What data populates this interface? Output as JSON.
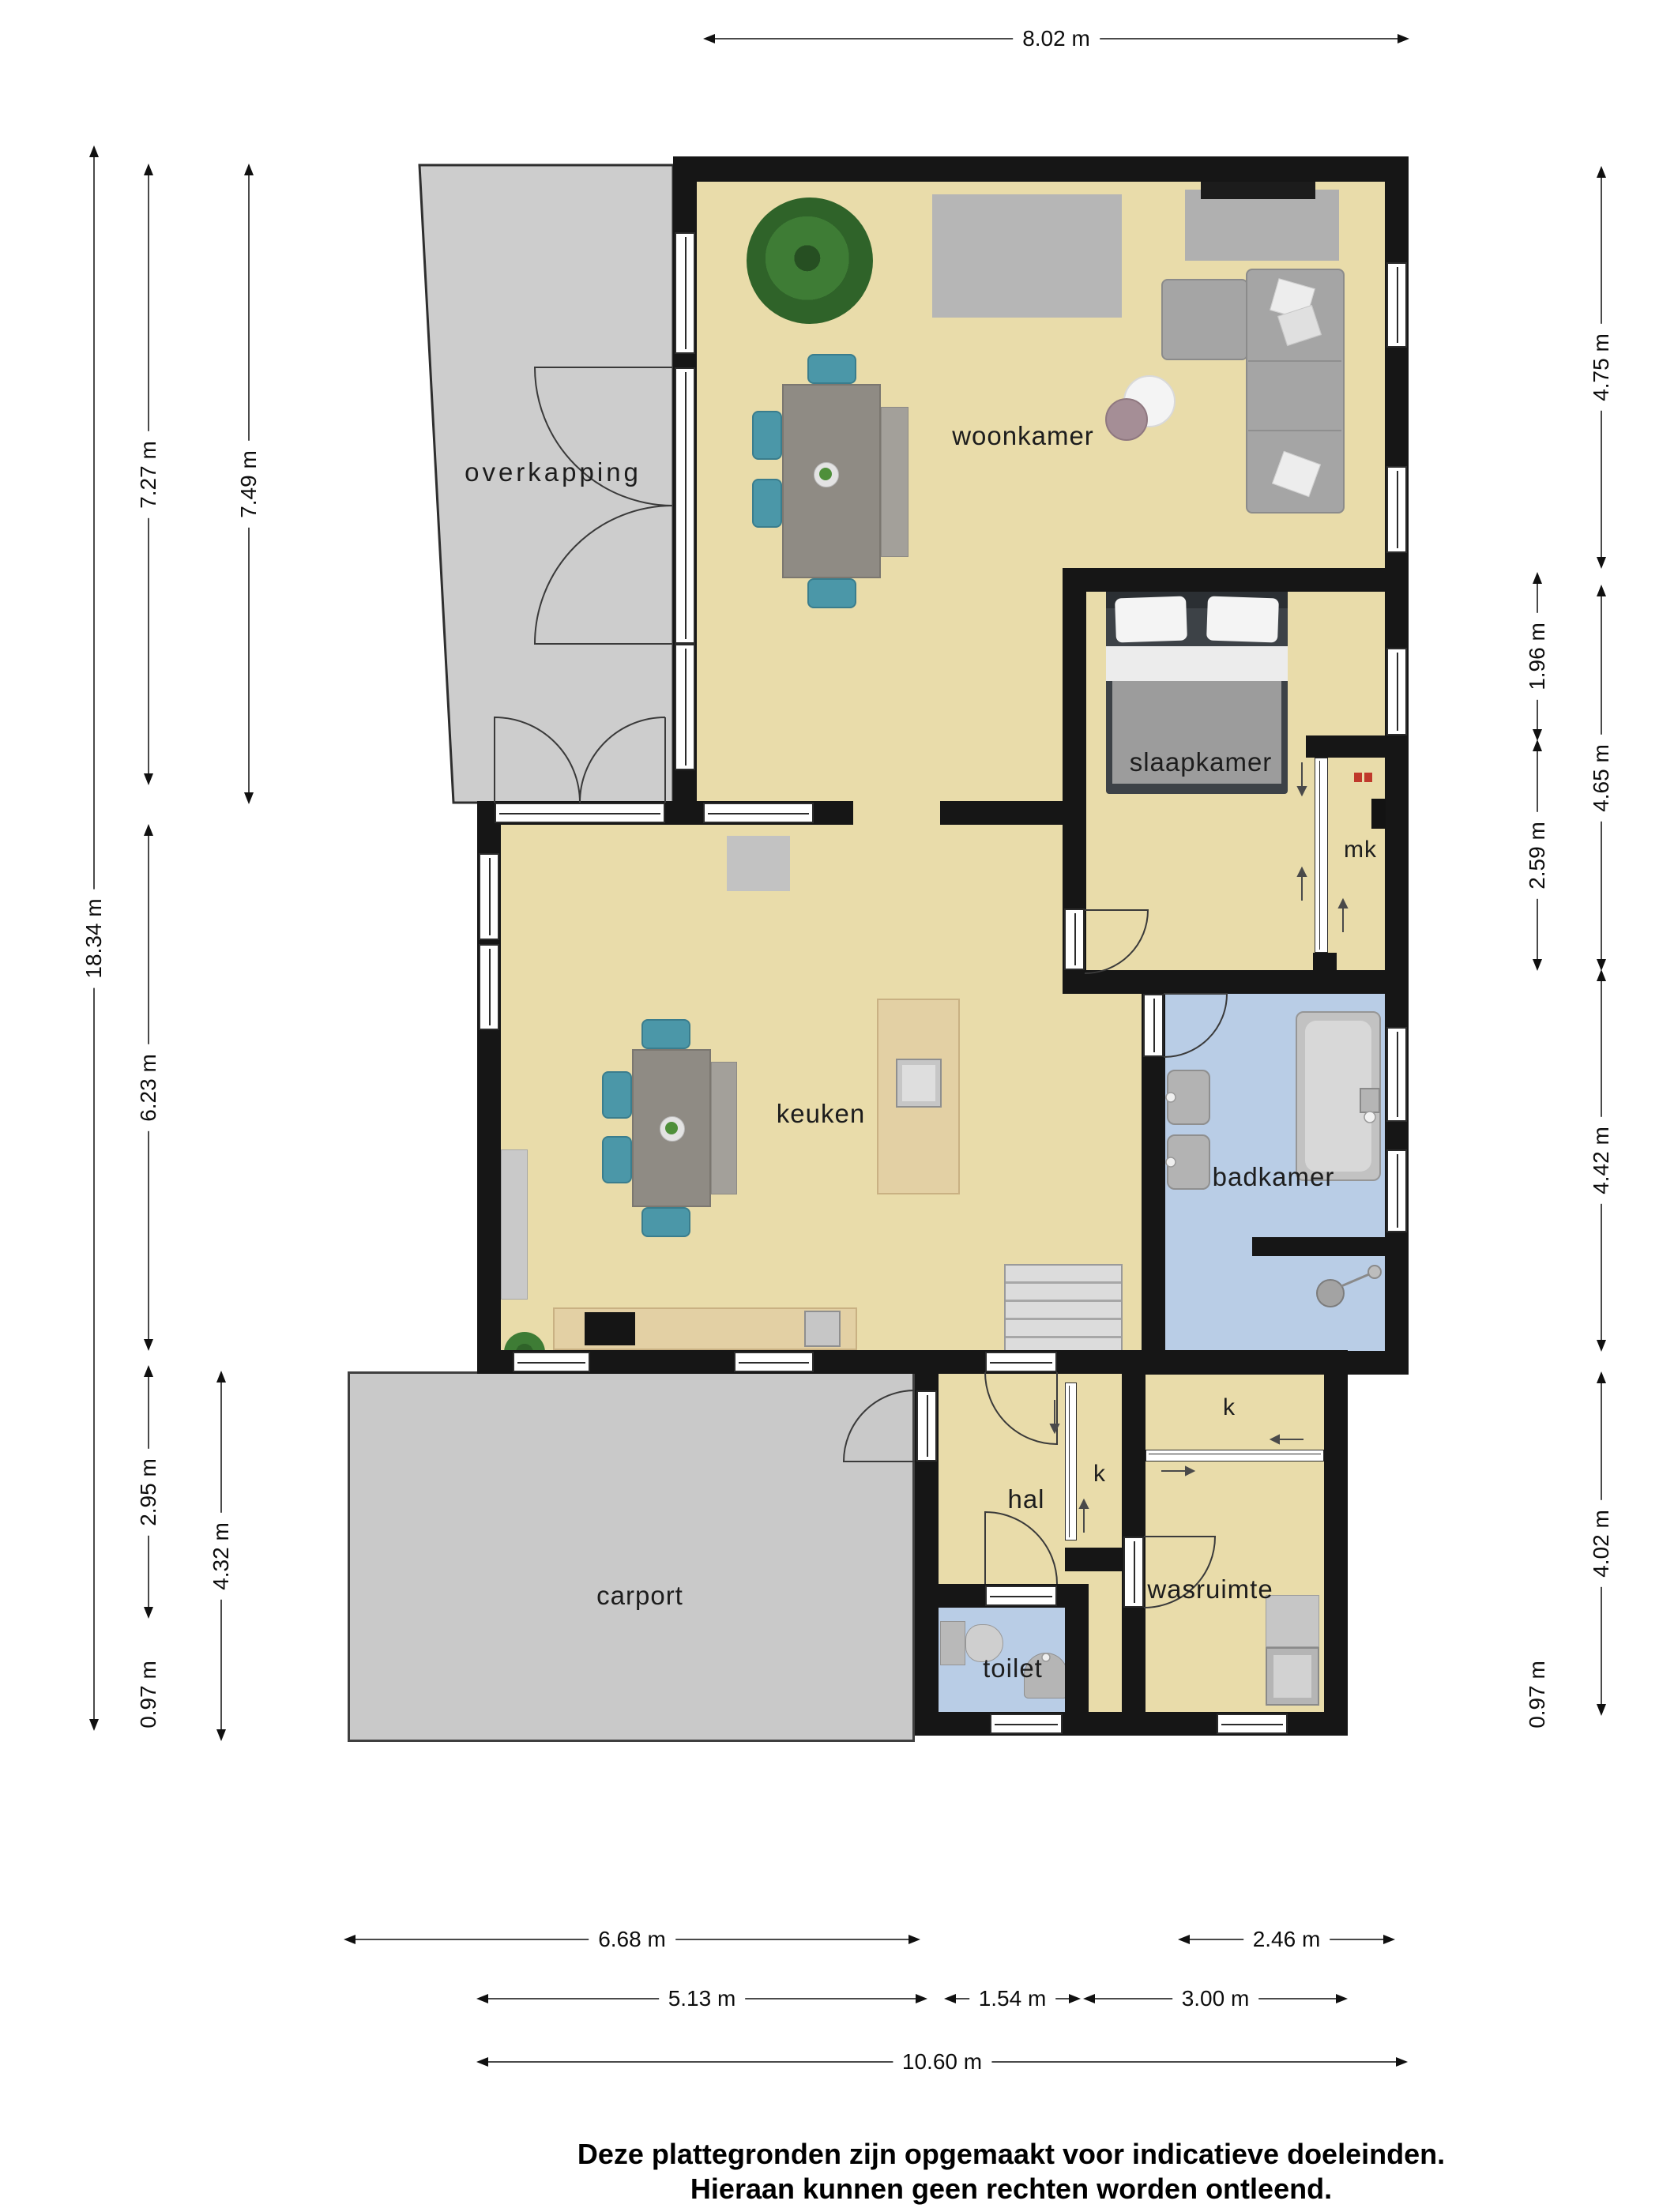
{
  "labels": {
    "woonkamer": "woonkamer",
    "overkapping": "overkapping",
    "slaapkamer": "slaapkamer",
    "mk": "mk",
    "keuken": "keuken",
    "badkamer": "badkamer",
    "hal": "hal",
    "k_closet_hal": "k",
    "k_closet_top": "k",
    "carport": "carport",
    "wasruimte": "wasruimte",
    "toilet": "toilet"
  },
  "dims": {
    "w_top": "8.02 m",
    "h_total": "18.34 m",
    "h_woonkamer_left": "7.27 m",
    "h_overkapping": "7.49 m",
    "h_keuken": "6.23 m",
    "h_keuken_lower": "2.95 m",
    "h_entry_left": "0.97 m",
    "h_carport": "4.32 m",
    "h_woonkamer_right": "4.75 m",
    "h_slaapkamer_upper": "1.96 m",
    "h_slaapkamer": "4.65 m",
    "h_slaapkamer_lower": "2.59 m",
    "h_badkamer": "4.42 m",
    "h_bottom_block": "4.02 m",
    "h_entry_right": "0.97 m",
    "w_carport": "6.68 m",
    "w_badkamer": "2.46 m",
    "w_keuken": "5.13 m",
    "w_hal": "1.54 m",
    "w_wasruimte": "3.00 m",
    "w_total": "10.60 m"
  },
  "disclaimer": {
    "line1": "Deze plattegronden zijn opgemaakt voor indicatieve doeleinden.",
    "line2": "Hieraan kunnen geen rechten worden ontleend."
  },
  "colors": {
    "floor": "#e9dcaa",
    "wet_floor": "#b9cde6",
    "wall": "#161616",
    "overkapping": "#cdcdcd",
    "carport": "#c9c9c9",
    "chair": "#4b97a8",
    "wood_counter": "#e3d0a4",
    "sofa": "#a5a5a5"
  }
}
